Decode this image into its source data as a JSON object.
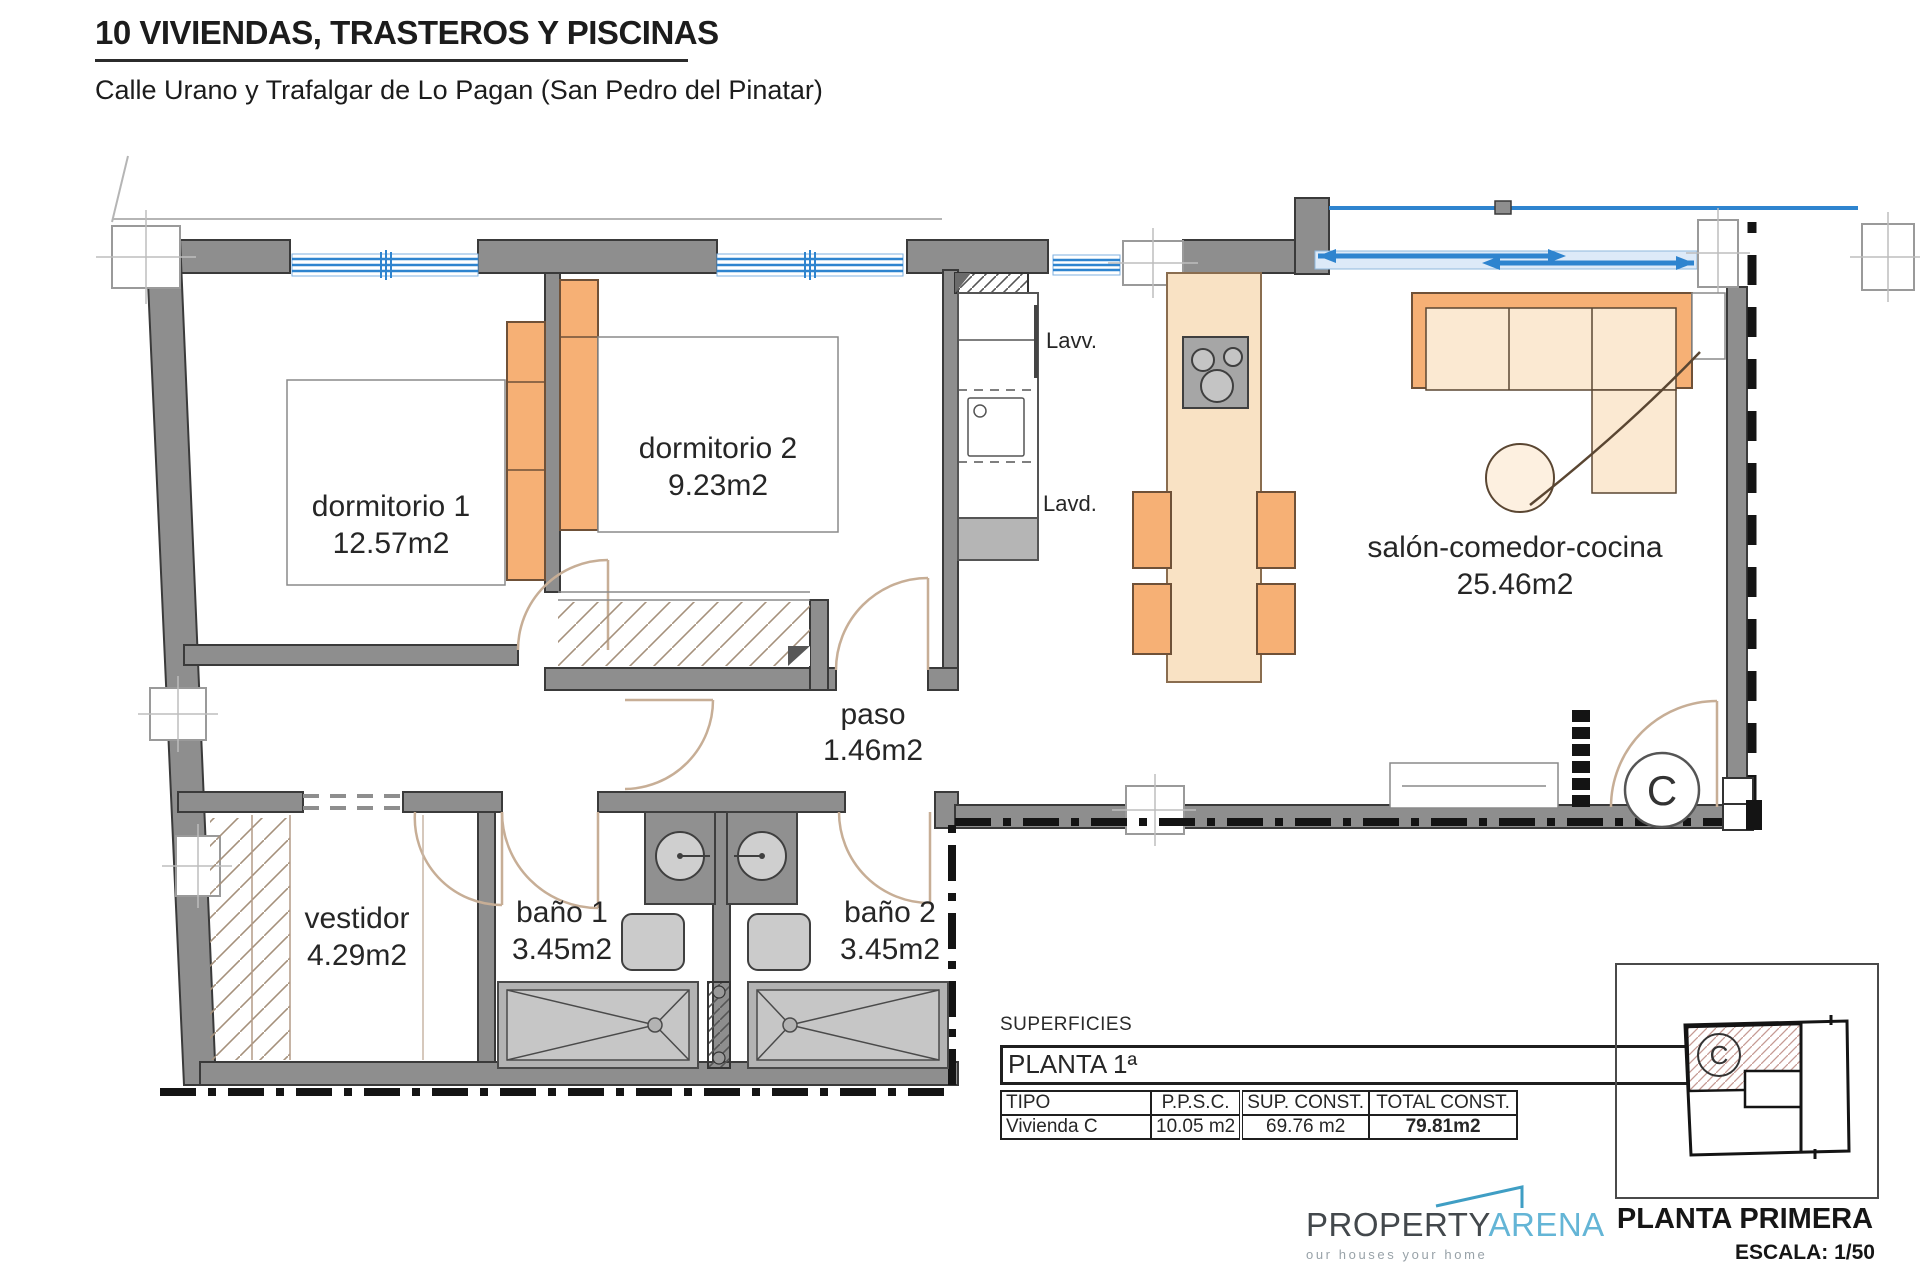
{
  "header": {
    "title": "10 VIVIENDAS, TRASTEROS Y PISCINAS",
    "subtitle": "Calle Urano y Trafalgar de Lo Pagan (San Pedro del Pinatar)"
  },
  "rooms": {
    "dormitorio1": {
      "name": "dormitorio 1",
      "area": "12.57m2"
    },
    "dormitorio2": {
      "name": "dormitorio 2",
      "area": "9.23m2"
    },
    "paso": {
      "name": "paso",
      "area": "1.46m2"
    },
    "vestidor": {
      "name": "vestidor",
      "area": "4.29m2"
    },
    "bano1": {
      "name": "baño 1",
      "area": "3.45m2"
    },
    "bano2": {
      "name": "baño 2",
      "area": "3.45m2"
    },
    "salon": {
      "name": "salón-comedor-cocina",
      "area": "25.46m2"
    }
  },
  "labels": {
    "lavv": "Lavv.",
    "lavd": "Lavd.",
    "unit_letter": "C"
  },
  "table": {
    "caption": "SUPERFICIES",
    "floor": "PLANTA 1ª",
    "headers": [
      "TIPO",
      "P.P.S.C.",
      "SUP. CONST.",
      "TOTAL CONST."
    ],
    "rows": [
      [
        "Vivienda C",
        "10.05 m2",
        "69.76 m2",
        "79.81m2"
      ]
    ]
  },
  "footer": {
    "brand_property": "PROPERTY",
    "brand_arena": "ARENA",
    "tagline": "our houses your home",
    "plan_name": "PLANTA PRIMERA",
    "scale": "ESCALA: 1/50"
  },
  "inset": {
    "unit_letter": "C"
  },
  "colors": {
    "wall_gray": "#8e8e8e",
    "window_blue": "#2e84cf",
    "furniture_orange": "#f6b075",
    "furniture_peach": "#fbe9d2",
    "door_arc": "#c7ae96",
    "brand_teal": "#64b5d6",
    "boundary_black": "#141414"
  }
}
